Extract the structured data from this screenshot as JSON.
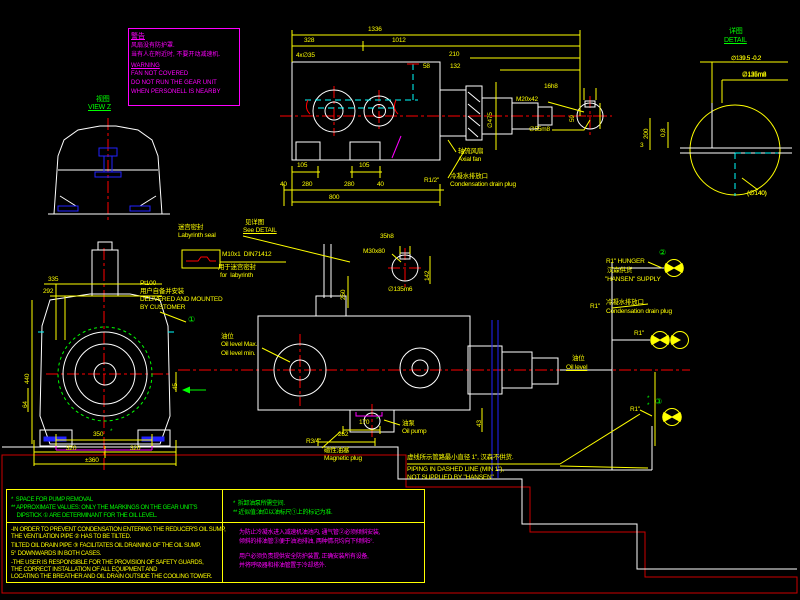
{
  "colors": {
    "dim": "#ffff00",
    "geometry": "#ffffff",
    "centerline": "#ff0000",
    "label_green": "#00ff00",
    "warning": "#ff00ff",
    "piping_dashed": "#00ffff",
    "parts_blue": "#2222ff",
    "border": "#cc0000"
  },
  "warning_box": {
    "title": "警告",
    "zh1": "风扇没有防护罩.",
    "zh2": "当有人在附近时, 不要开动减速机.",
    "en_title": "WARNING",
    "en1": "FAN NOT COVERED",
    "en2": "DO NOT RUN THE GEAR UNIT",
    "en3": "WHEN PERSONELL IS NEARBY"
  },
  "view_z": {
    "zh": "视图",
    "en": "VIEW Z"
  },
  "detail_view": {
    "zh": "详图",
    "en": "DETAIL",
    "dia_tol": "∅139.5 -0.2",
    "dia_shaft": "∅135m8",
    "dia_ref": "(∅140)"
  },
  "labyrinth": {
    "zh": "迷宫密封",
    "en": "Labyrinth seal"
  },
  "see_detail": {
    "zh": "见详图",
    "en": "See DETAIL"
  },
  "grease": {
    "spec": "M10x1  DIN71412",
    "zh": "用于迷宫密封",
    "en": "for  labyrinth"
  },
  "axial_fan": {
    "zh": "轴流风扇",
    "en": "Axial fan"
  },
  "drain_top": {
    "size": "R1/2\"",
    "zh": "冷凝水排放口",
    "en": "Condensation drain plug"
  },
  "pt100": {
    "tag": "Pt100",
    "zh": "用户自备并安装",
    "en1": "DELIVERED AND MOUNTED",
    "en2": "BY CUSTOMER",
    "circle1": "①"
  },
  "oil_level_left": {
    "zh": "油位",
    "max": "Oil level Max.",
    "min": "Oil level min."
  },
  "oil_pump": {
    "zh": "油泵",
    "en": "Oil pump"
  },
  "magnetic_plug": {
    "size": "R3/4\"",
    "zh": "磁性油塞",
    "en": "Magnetic plug"
  },
  "hansen_supply": {
    "line1": "R1\" HUNGER",
    "circle2": "②",
    "zh": "汉森供货",
    "line2": "\"HANSEN\" SUPPLY"
  },
  "cond_right": {
    "size": "R1\"",
    "zh": "冷凝水排放口",
    "en": "Condensation drain plug"
  },
  "valve_mid": {
    "size": "R1\""
  },
  "oil_level_right": {
    "zh": "油位",
    "en": "Oil level",
    "star1": "*",
    "star2": "*"
  },
  "valve_bottom": {
    "size": "R1\"",
    "circle3": "③"
  },
  "piping_note": {
    "zh": "虚线所示管路最小直径 1\", 汉森不供货.",
    "en1": "PIPING IN DASHED LINE (MIN 1\"),",
    "en2": "NOT SUPPLIED BY \"HANSEN\""
  },
  "notes": {
    "en": [
      "*  SPACE FOR PUMP REMOVAL",
      "** APPROXIMATE VALUES: ONLY THE MARKINGS ON THE GEAR UNIT'S",
      "    DIPSTICK ① ARE DETERMINANT FOR THE OIL LEVEL.",
      "-IN ORDER TO PREVENT CONDENSATION ENTERING THE REDUCER'S OIL SUMP,",
      "THE VENTILATION PIPE ② HAS TO BE TILTED.",
      "TILTED OIL DRAIN PIPE ③ FACILITATES OIL DRAINING OF THE OIL SUMP.",
      "5° DOWNWARDS IN BOTH CASES.",
      "-THE USER IS RESPONSIBLE FOR THE PROVISION OF SAFETY GUARDS,",
      "THE CORRECT INSTALLATION OF ALL EQUIPMENT AND",
      "LOCATING THE BREATHER AND OIL DRAIN OUTSIDE THE COOLING TOWER."
    ],
    "zh": [
      "*  拆卸油泵所需空间.",
      "** 近似值:油位以油标尺①上的标记为准.",
      "为防止冷凝水进入减速机油池内, 通气管②必须倾斜安装,",
      "倾斜的排油管③便于油池排油, 两种情况均向下倾斜5°.",
      "用户必须负责提供安全防护装置, 正确安装所有设备,",
      "并将呼吸器和排油管置于冷却塔外."
    ]
  },
  "annotations": [
    {
      "t": "1336",
      "x": 368,
      "y": 27
    },
    {
      "t": "328",
      "x": 304,
      "y": 38
    },
    {
      "t": "1012",
      "x": 392,
      "y": 38
    },
    {
      "t": "4x∅35",
      "x": 296,
      "y": 53
    },
    {
      "t": "210",
      "x": 449,
      "y": 52
    },
    {
      "t": "58",
      "x": 423,
      "y": 64
    },
    {
      "t": "132",
      "x": 450,
      "y": 64
    },
    {
      "t": "M20x42",
      "x": 516,
      "y": 97
    },
    {
      "t": "16h8",
      "x": 544,
      "y": 84
    },
    {
      "t": "∅55m8",
      "x": 529,
      "y": 127
    },
    {
      "t": "59",
      "x": 570,
      "y": 122,
      "r": 1
    },
    {
      "t": "∅475",
      "x": 488,
      "y": 128,
      "r": 1
    },
    {
      "t": "105",
      "x": 297,
      "y": 163
    },
    {
      "t": "105",
      "x": 359,
      "y": 163
    },
    {
      "t": "40",
      "x": 280,
      "y": 182
    },
    {
      "t": "280",
      "x": 302,
      "y": 182
    },
    {
      "t": "280",
      "x": 344,
      "y": 182
    },
    {
      "t": "40",
      "x": 377,
      "y": 182
    },
    {
      "t": "800",
      "x": 329,
      "y": 195
    },
    {
      "t": "335",
      "x": 48,
      "y": 277
    },
    {
      "t": "292",
      "x": 43,
      "y": 289
    },
    {
      "t": "440",
      "x": 25,
      "y": 384,
      "r": 1
    },
    {
      "t": "64",
      "x": 23,
      "y": 408,
      "r": 1
    },
    {
      "t": "45",
      "x": 173,
      "y": 390,
      "r": 1
    },
    {
      "t": "350",
      "x": 93,
      "y": 432
    },
    {
      "t": "*",
      "x": 110,
      "y": 429,
      "c": "g"
    },
    {
      "t": "320",
      "x": 66,
      "y": 446
    },
    {
      "t": "320",
      "x": 130,
      "y": 446
    },
    {
      "t": "±360",
      "x": 85,
      "y": 458
    },
    {
      "t": "35h8",
      "x": 380,
      "y": 234
    },
    {
      "t": "M30x80",
      "x": 363,
      "y": 249
    },
    {
      "t": "142",
      "x": 425,
      "y": 281,
      "r": 1
    },
    {
      "t": "∅135m6",
      "x": 388,
      "y": 287
    },
    {
      "t": "250",
      "x": 341,
      "y": 300,
      "r": 1
    },
    {
      "t": "170",
      "x": 359,
      "y": 420
    },
    {
      "t": "*",
      "x": 376,
      "y": 417,
      "c": "g"
    },
    {
      "t": "262",
      "x": 338,
      "y": 432
    },
    {
      "t": "43",
      "x": 477,
      "y": 427,
      "r": 1
    },
    {
      "t": "∅139.5 -0.2",
      "x": 731,
      "y": 56,
      "s": 6
    },
    {
      "t": "∅135m8",
      "x": 742,
      "y": 73
    },
    {
      "t": "(∅140)",
      "x": 747,
      "y": 191
    },
    {
      "t": "200",
      "x": 644,
      "y": 139,
      "r": 1
    },
    {
      "t": "0,8",
      "x": 661,
      "y": 137,
      "r": 1
    },
    {
      "t": "3",
      "x": 640,
      "y": 143
    }
  ]
}
